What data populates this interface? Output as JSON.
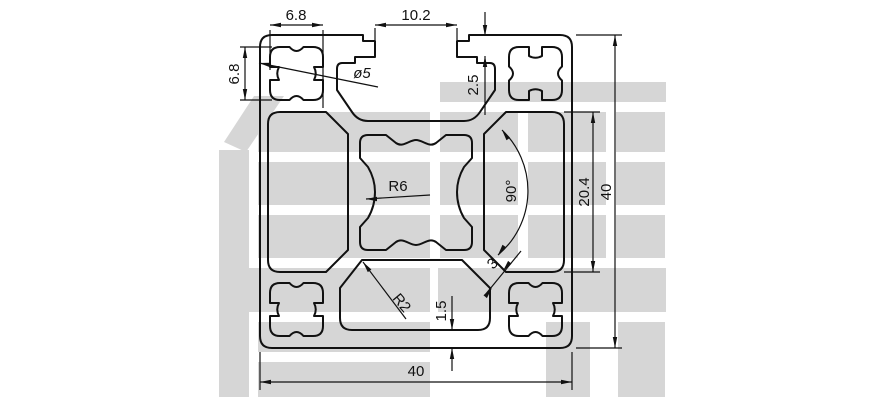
{
  "drawing": {
    "line_color": "#111111",
    "watermark": {
      "text": "信牌",
      "color": "#d6d6d6"
    },
    "dims": {
      "corner_width": "6.8",
      "slot_opening": "10.2",
      "corner_height": "6.8",
      "screw_hole": "ø5",
      "lip_depth": "2.5",
      "core_radius": "R6",
      "groove_angle": "90°",
      "cavity_height": "20.4",
      "overall_height": "40",
      "wall_gap": "3",
      "corner_fillet": "R2",
      "bottom_wall": "1.5",
      "overall_width": "40"
    }
  }
}
